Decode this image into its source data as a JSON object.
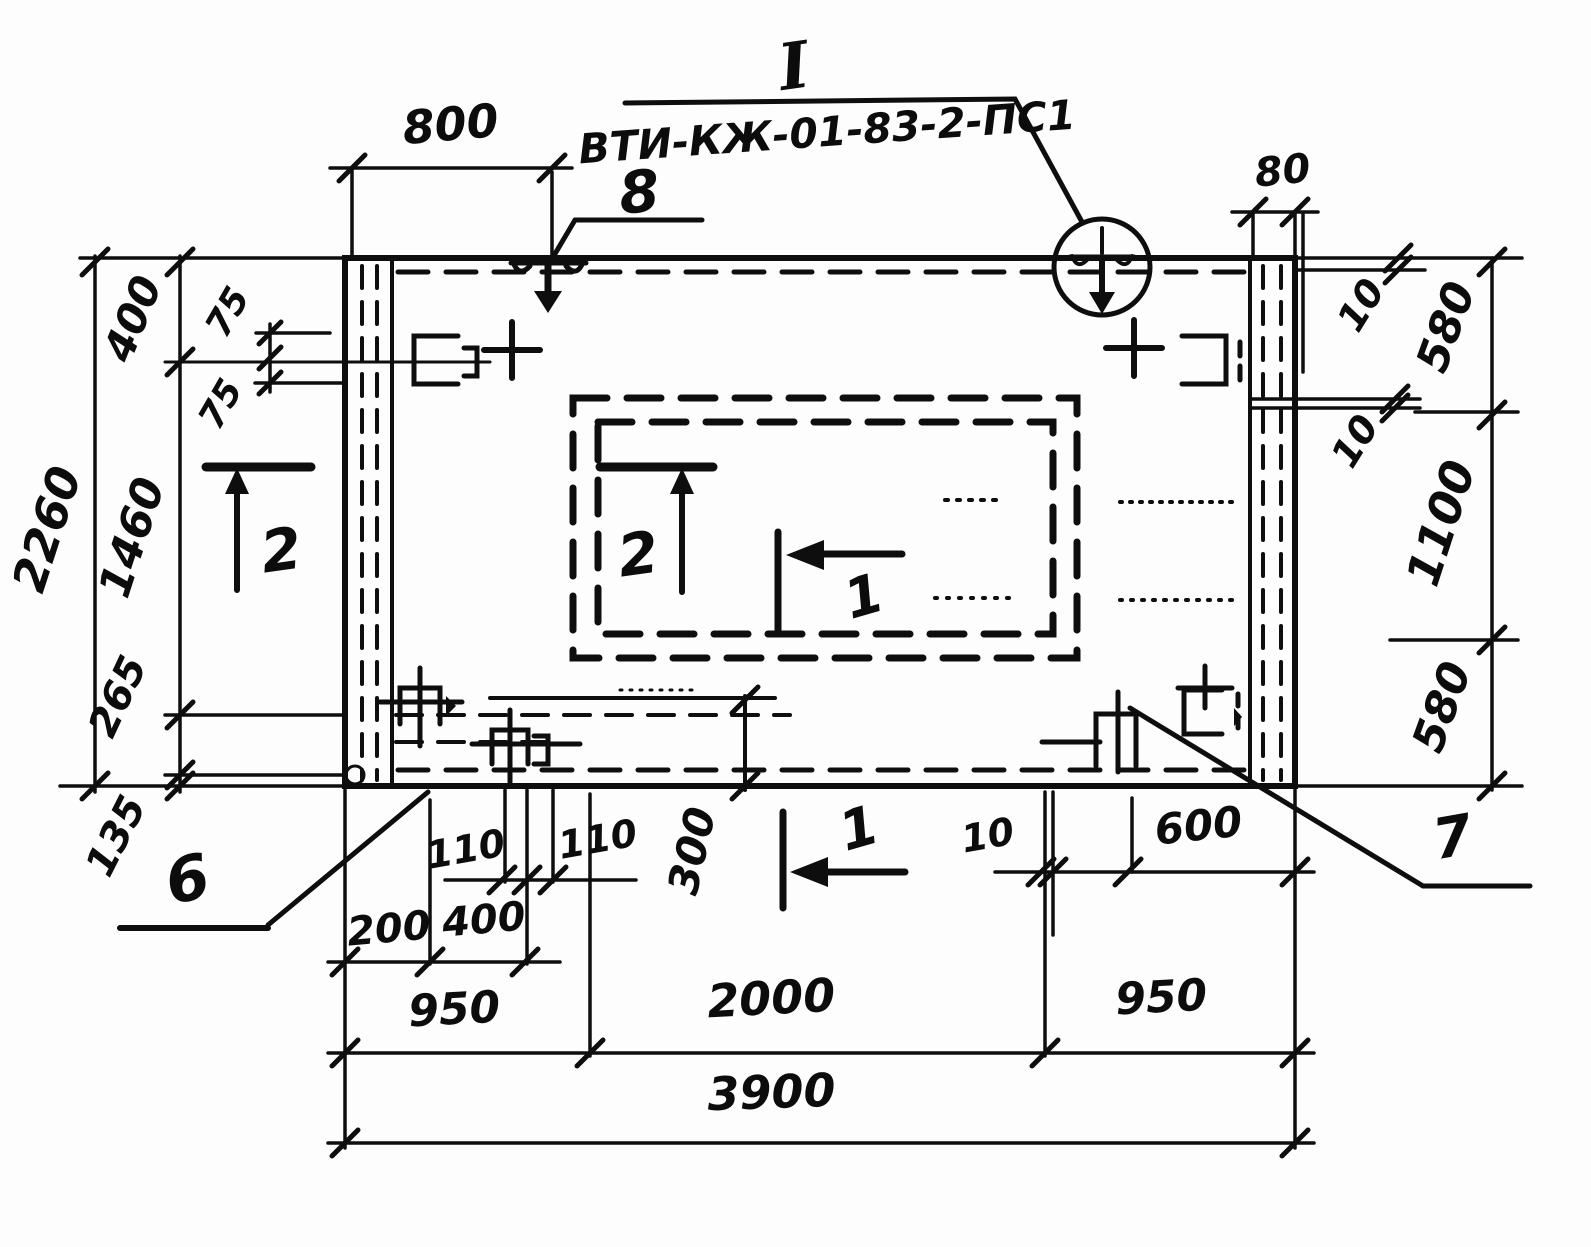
{
  "drawing": {
    "type": "reinforced-concrete-panel-plan",
    "detail_marker": "I",
    "panel_mark": "ВТИ-КЖ-01-83-2-ПС1",
    "callouts": [
      "8",
      "6",
      "7"
    ],
    "section_marks": [
      "1",
      "2"
    ],
    "dimensions_mm": {
      "top": [
        "800",
        "80"
      ],
      "right": [
        "10",
        "580",
        "10",
        "1100",
        "580"
      ],
      "left": [
        "2260",
        "400",
        "75",
        "75",
        "1460",
        "265",
        "135"
      ],
      "bottom": [
        "110",
        "110",
        "300",
        "200",
        "400",
        "10",
        "600",
        "950",
        "2000",
        "950",
        "3900"
      ]
    },
    "ink_color": "#0e0e0e",
    "paper_color": "#fdfdfd"
  },
  "labels": [
    {
      "name": "detail-marker-label",
      "text": "I",
      "x": 797,
      "y": 88,
      "rot": -8,
      "size": 64,
      "serif": true
    },
    {
      "name": "panel-mark-label",
      "text": "ВТИ-КЖ-01-83-2-ПС1",
      "x": 828,
      "y": 146,
      "rot": -4,
      "size": 41
    },
    {
      "name": "callout-8-label",
      "text": "8",
      "x": 641,
      "y": 212,
      "rot": -5,
      "size": 58
    },
    {
      "name": "callout-6-label",
      "text": "6",
      "x": 192,
      "y": 900,
      "rot": -12,
      "size": 62
    },
    {
      "name": "callout-7-label",
      "text": "7",
      "x": 1456,
      "y": 856,
      "rot": -10,
      "size": 56
    },
    {
      "name": "section-2-left-label",
      "text": "2",
      "x": 284,
      "y": 570,
      "rot": -8,
      "size": 58
    },
    {
      "name": "section-2-inner-label",
      "text": "2",
      "x": 641,
      "y": 574,
      "rot": -8,
      "size": 58
    },
    {
      "name": "section-1-inner-label",
      "text": "1",
      "x": 869,
      "y": 614,
      "rot": -16,
      "size": 54
    },
    {
      "name": "section-1-bottom-label",
      "text": "1",
      "x": 864,
      "y": 846,
      "rot": -16,
      "size": 54
    },
    {
      "name": "dim-800",
      "text": "800",
      "x": 452,
      "y": 140,
      "rot": -5,
      "size": 46
    },
    {
      "name": "dim-80",
      "text": "80",
      "x": 1284,
      "y": 184,
      "rot": -6,
      "size": 40
    },
    {
      "name": "dim-10-right-top",
      "text": "10",
      "x": 1372,
      "y": 312,
      "rot": -58,
      "size": 38
    },
    {
      "name": "dim-580-right-top",
      "text": "580",
      "x": 1460,
      "y": 332,
      "rot": -70,
      "size": 44
    },
    {
      "name": "dim-10-right-mid",
      "text": "10",
      "x": 1366,
      "y": 448,
      "rot": -58,
      "size": 38
    },
    {
      "name": "dim-1100",
      "text": "1100",
      "x": 1456,
      "y": 528,
      "rot": -72,
      "size": 46
    },
    {
      "name": "dim-580-right-bottom",
      "text": "580",
      "x": 1456,
      "y": 712,
      "rot": -70,
      "size": 44
    },
    {
      "name": "dim-2260",
      "text": "2260",
      "x": 62,
      "y": 534,
      "rot": -72,
      "size": 46
    },
    {
      "name": "dim-400-left",
      "text": "400",
      "x": 146,
      "y": 324,
      "rot": -68,
      "size": 42
    },
    {
      "name": "dim-75-upper",
      "text": "75",
      "x": 238,
      "y": 318,
      "rot": -60,
      "size": 36
    },
    {
      "name": "dim-75-lower",
      "text": "75",
      "x": 231,
      "y": 410,
      "rot": -60,
      "size": 36
    },
    {
      "name": "dim-1460",
      "text": "1460",
      "x": 146,
      "y": 542,
      "rot": -72,
      "size": 44
    },
    {
      "name": "dim-265",
      "text": "265",
      "x": 130,
      "y": 702,
      "rot": -65,
      "size": 40
    },
    {
      "name": "dim-135",
      "text": "135",
      "x": 128,
      "y": 842,
      "rot": -63,
      "size": 40
    },
    {
      "name": "dim-300",
      "text": "300",
      "x": 706,
      "y": 854,
      "rot": -77,
      "size": 42
    },
    {
      "name": "dim-110-left",
      "text": "110",
      "x": 468,
      "y": 862,
      "rot": -10,
      "size": 38
    },
    {
      "name": "dim-110-right",
      "text": "110",
      "x": 600,
      "y": 852,
      "rot": -10,
      "size": 38
    },
    {
      "name": "dim-200",
      "text": "200",
      "x": 390,
      "y": 942,
      "rot": -5,
      "size": 40
    },
    {
      "name": "dim-400-bottom",
      "text": "400",
      "x": 485,
      "y": 933,
      "rot": -5,
      "size": 40
    },
    {
      "name": "dim-10-bottom",
      "text": "10",
      "x": 990,
      "y": 848,
      "rot": -10,
      "size": 38
    },
    {
      "name": "dim-600",
      "text": "600",
      "x": 1200,
      "y": 840,
      "rot": -6,
      "size": 42
    },
    {
      "name": "dim-950-left",
      "text": "950",
      "x": 455,
      "y": 1024,
      "rot": -3,
      "size": 44
    },
    {
      "name": "dim-2000",
      "text": "2000",
      "x": 772,
      "y": 1014,
      "rot": -3,
      "size": 46
    },
    {
      "name": "dim-950-right",
      "text": "950",
      "x": 1162,
      "y": 1012,
      "rot": -3,
      "size": 44
    },
    {
      "name": "dim-3900",
      "text": "3900",
      "x": 772,
      "y": 1108,
      "rot": -2,
      "size": 46
    }
  ]
}
